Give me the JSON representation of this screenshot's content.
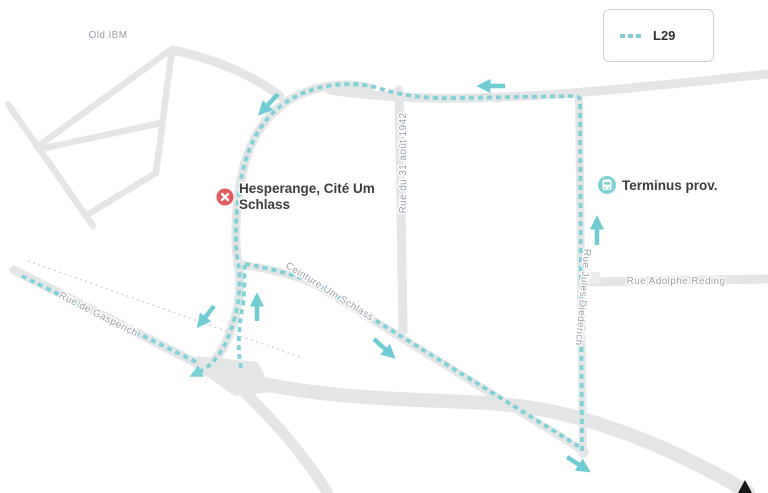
{
  "legend": {
    "route_label": "L29"
  },
  "stops": {
    "closed_stop": {
      "title_line1": "Hesperange, Cité Um",
      "title_line2": "Schlass",
      "status": "closed"
    },
    "terminus": {
      "label": "Terminus prov."
    }
  },
  "streets": {
    "old_ibm": "Old IBM",
    "rue_31_aout": "Rue du 31 août 1942",
    "rue_jules_diederich": "Rue Jules Diederich",
    "rue_adolphe_reding": "Rue Adolphe Reding",
    "ceinture_um_schlass": "Ceinture Um Schlass",
    "rue_de_gasperich": "Rue de Gasperich"
  },
  "colors": {
    "background": "#ffffff",
    "road": "#e4e5e7",
    "route": "#7ed1d6",
    "arrow": "#70cbd2",
    "closed_stop": "#e25c5c",
    "terminus": "#7fd0d5",
    "street_label": "#9aa0a8",
    "stop_label": "#3c3c3c"
  }
}
